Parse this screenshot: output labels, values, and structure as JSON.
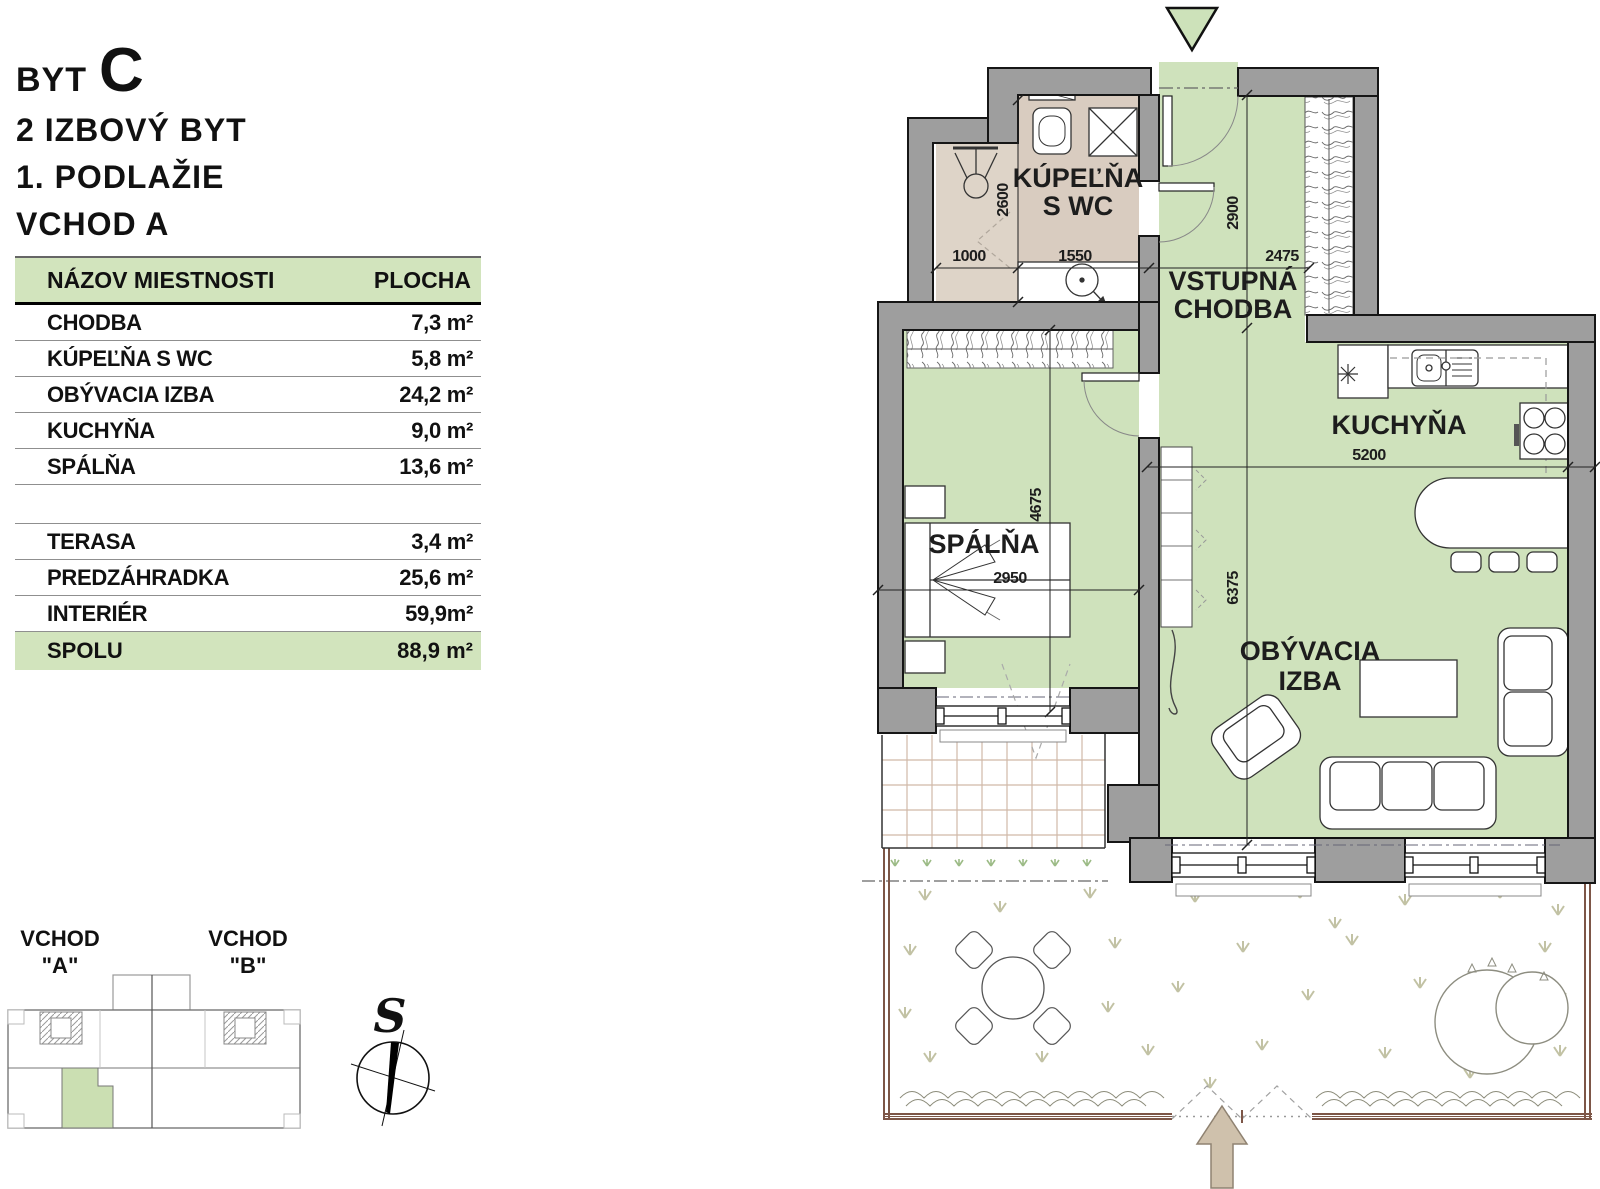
{
  "title": {
    "prefix": "BYT",
    "letter": "C",
    "type_line": "2 IZBOVÝ BYT",
    "floor_line": "1. PODLAŽIE",
    "entrance_line": "VCHOD A"
  },
  "area_table": {
    "col_room": "NÁZOV MIESTNOSTI",
    "col_area": "PLOCHA",
    "rooms": [
      {
        "label": "CHODBA",
        "value": "7,3 m²"
      },
      {
        "label": "KÚPEĽŇA S WC",
        "value": "5,8 m²"
      },
      {
        "label": "OBÝVACIA IZBA",
        "value": "24,2 m²"
      },
      {
        "label": "KUCHYŇA",
        "value": "9,0 m²"
      },
      {
        "label": "SPÁLŇA",
        "value": "13,6 m²"
      }
    ],
    "exterior": [
      {
        "label": "TERASA",
        "value": "3,4 m²"
      },
      {
        "label": "PREDZÁHRADKA",
        "value": "25,6 m²"
      },
      {
        "label": "INTERIÉR",
        "value": "59,9m²"
      }
    ],
    "total": {
      "label": "SPOLU",
      "value": "88,9 m²"
    }
  },
  "key_plan": {
    "entrance_a": "VCHOD",
    "entrance_a_id": "\"A\"",
    "entrance_b": "VCHOD",
    "entrance_b_id": "\"B\"",
    "compass_north": "S"
  },
  "plan": {
    "rooms": {
      "bathroom_line1": "KÚPEĽŇA",
      "bathroom_line2": "S WC",
      "hall_line1": "VSTUPNÁ",
      "hall_line2": "CHODBA",
      "kitchen": "KUCHYŇA",
      "bedroom": "SPÁLŇA",
      "living_line1": "OBÝVACIA",
      "living_line2": "IZBA"
    },
    "dimensions": {
      "shower_width": "1000",
      "bathroom_width": "1550",
      "bathroom_depth": "2600",
      "hall_depth": "2900",
      "hall_width": "2475",
      "kitchen_width": "5200",
      "bedroom_width": "2950",
      "bedroom_depth": "4675",
      "living_depth": "6375"
    }
  },
  "colors": {
    "room_fill": "#cfe2bc",
    "bathroom_fill": "#d9ccc0",
    "shower_fill": "#ded4c8",
    "wall_fill": "#9e9e9e",
    "table_accent": "#d2e4bd",
    "fence_brown": "#7d5647",
    "arrow_fill": "#cfc1ac"
  }
}
